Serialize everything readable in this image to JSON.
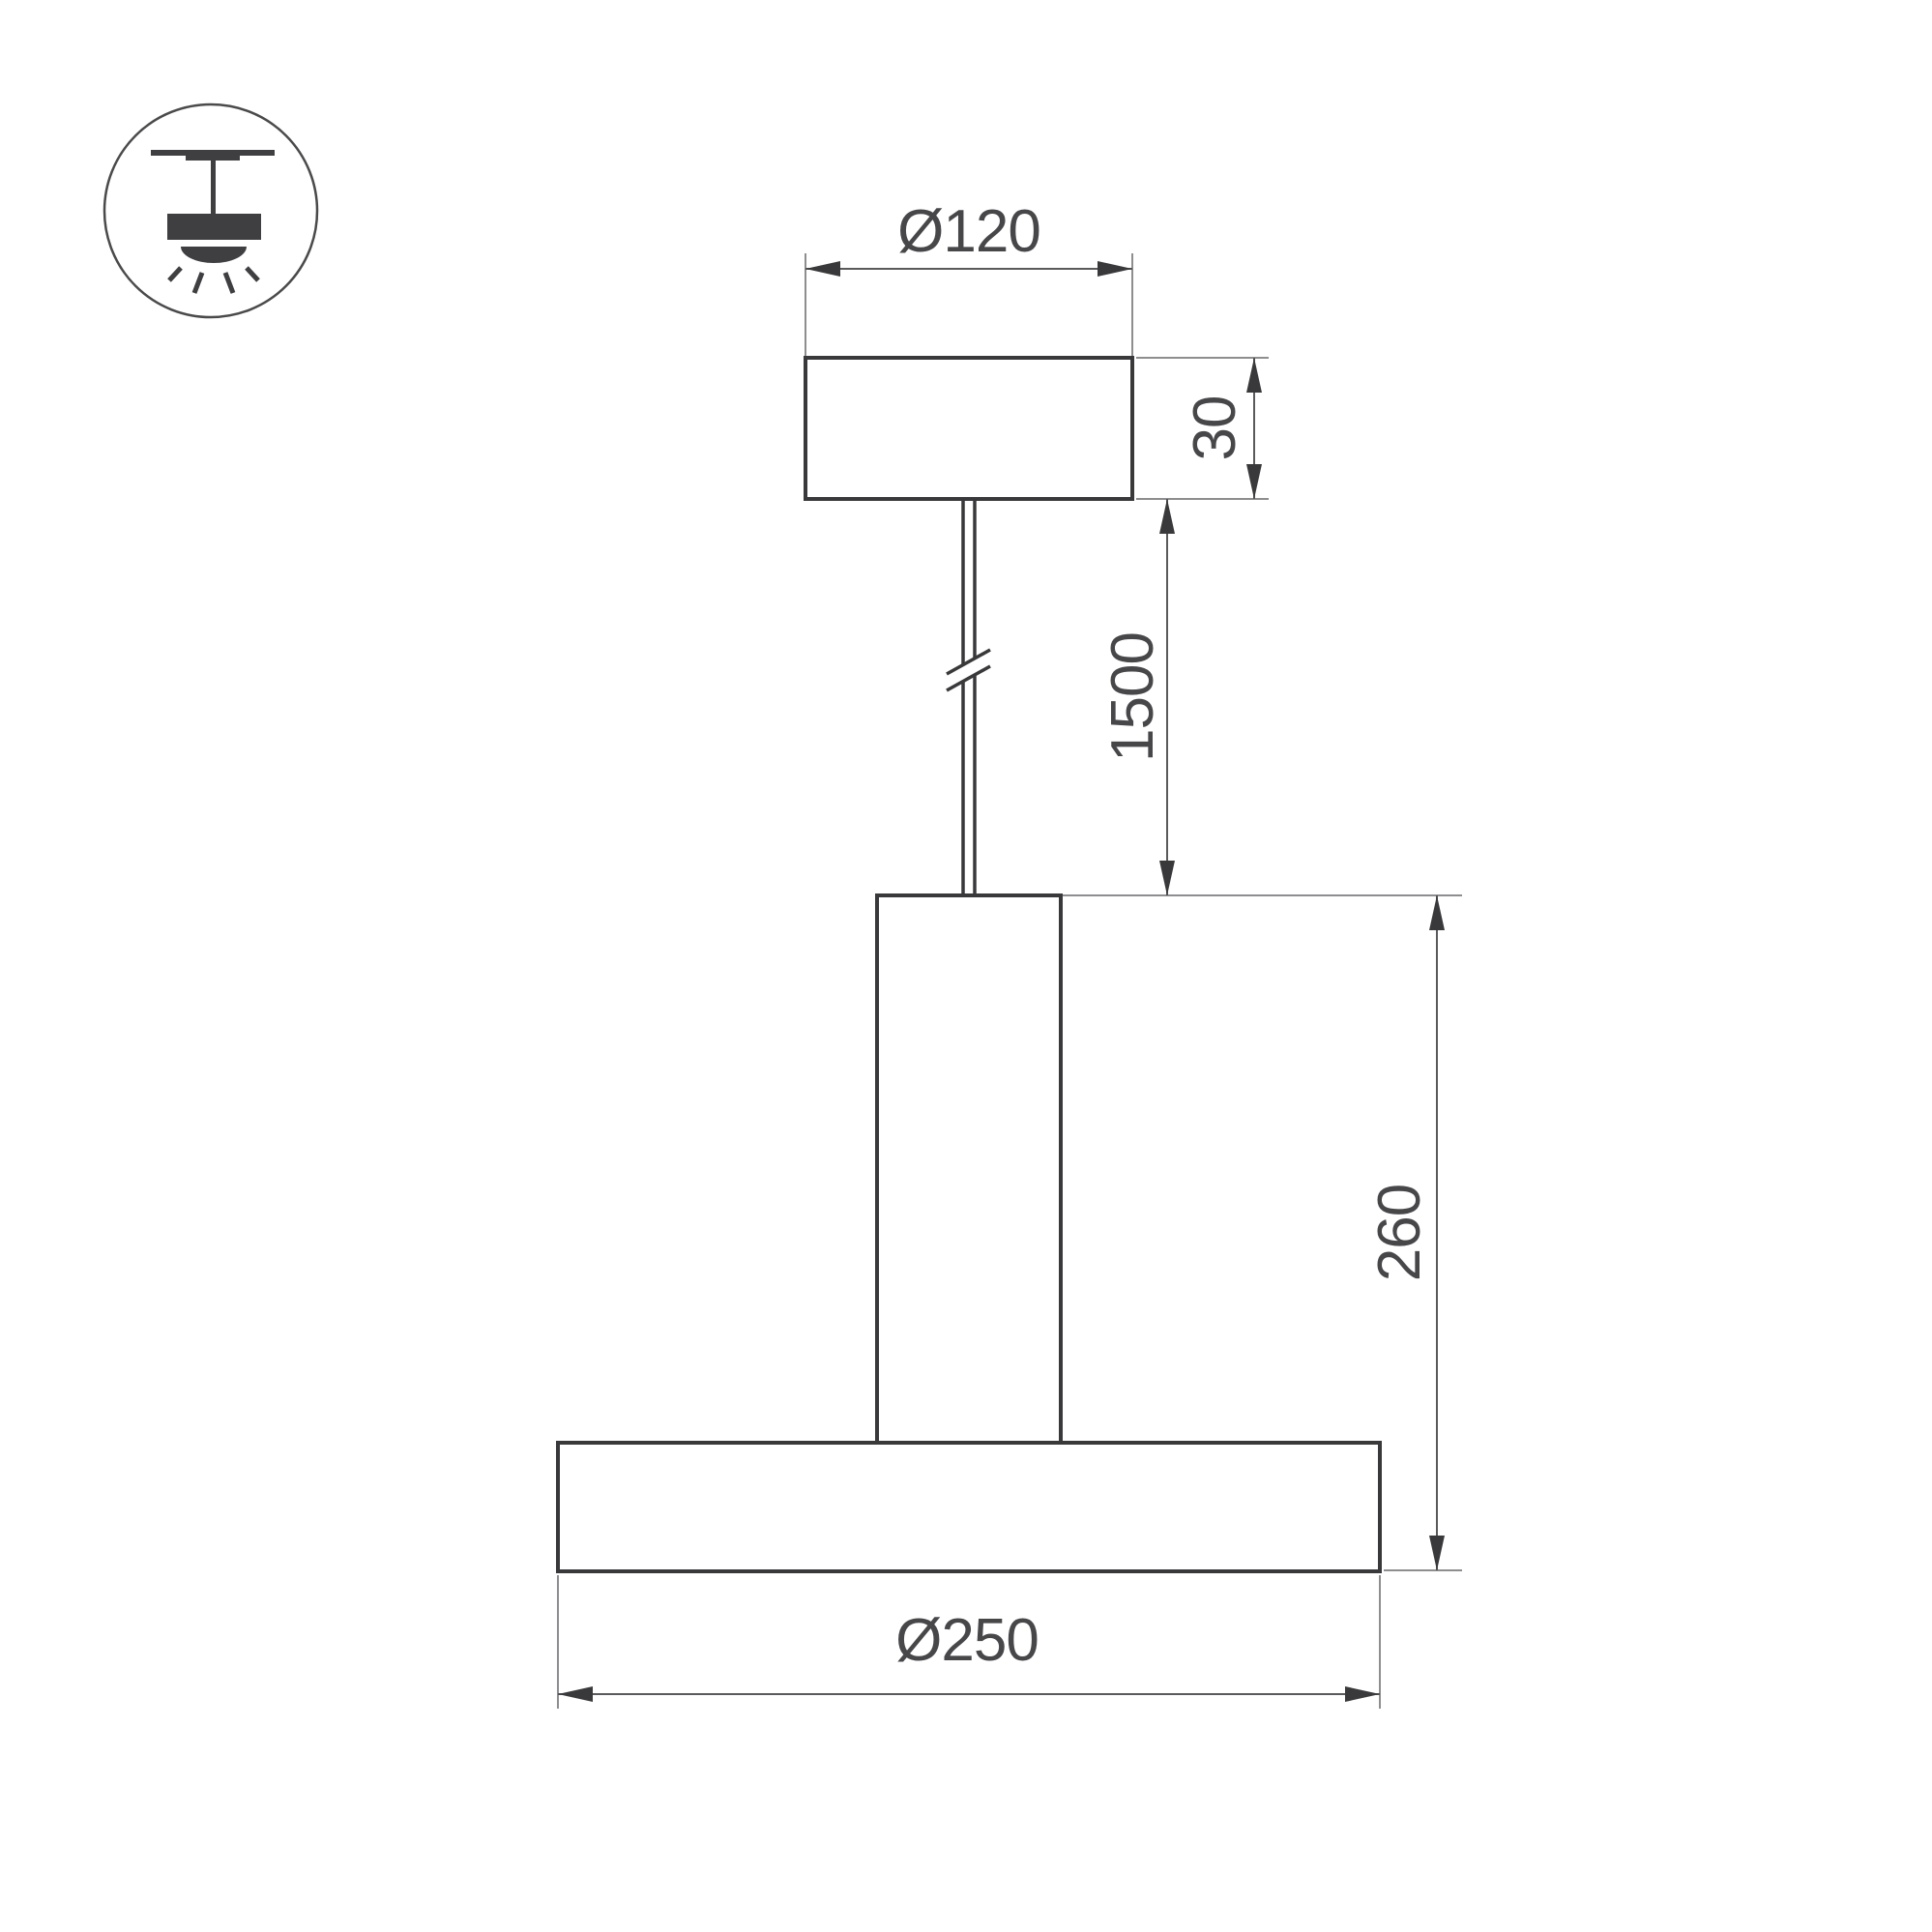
{
  "drawing": {
    "type": "technical-dimension-drawing",
    "subject": "pendant-light-fixture"
  },
  "icon": {
    "name": "pendant-ceiling-light-icon",
    "description": "suspended luminaire symbol in circle"
  },
  "labels": {
    "canopy_diameter": "Ø120",
    "canopy_height": "30",
    "suspension_length": "1500",
    "fixture_height": "260",
    "plate_diameter": "Ø250"
  },
  "colors": {
    "object_line": "#39393b",
    "dimension_line": "#5a5a5c",
    "extension_line": "#8e8e90",
    "label_text": "#47474a",
    "background": "#ffffff"
  }
}
